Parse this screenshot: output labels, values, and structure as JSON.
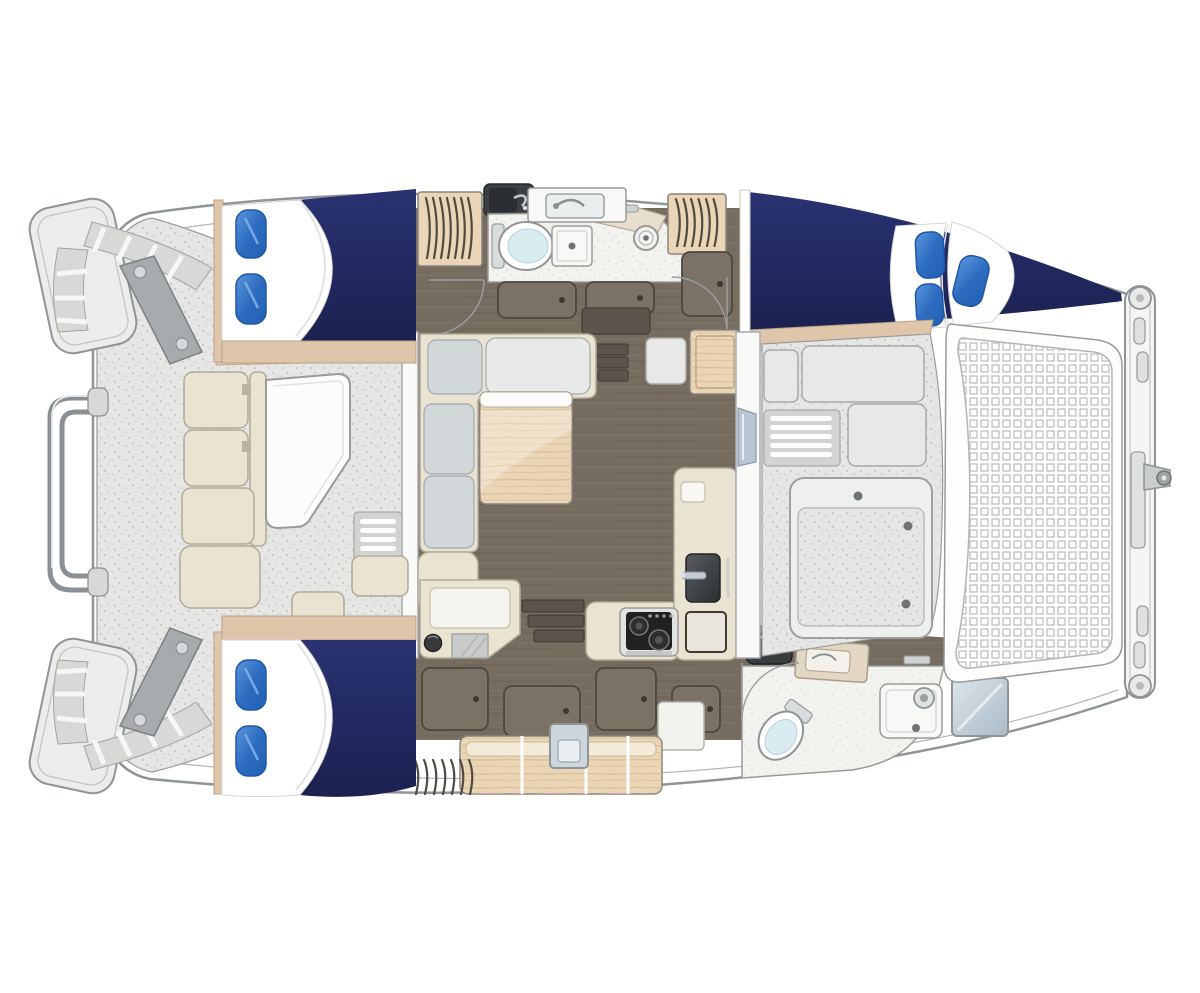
{
  "title": "Catamaran interior layout floor plan (top view)",
  "palette": {
    "hull-stroke": "#8f9496",
    "line-light": "#b3b7b9",
    "deck": "#e6e6e4",
    "deck-dot": "#c7c7c5",
    "deck-stroke": "#9a9a98",
    "navy": "#222a5e",
    "navy-dark": "#1a2150",
    "pillow": "#2e6cc0",
    "pillow-dark": "#1f57a8",
    "tan": "#dfc6ab",
    "salmon": "#e9c6ac",
    "wood": "#ead5b6",
    "wood-grain": "#d8b88e",
    "slat": "#4f4a42",
    "floor": "#766b5f",
    "streak-light": "#8a8072",
    "streak-dark": "#5f574d",
    "cream": "#e9e4d1",
    "cream-stroke": "#b0aa99",
    "gray-cushion": "#d2d7d9",
    "block": "#e8e8e6",
    "block-stroke": "#a9a9a7",
    "mesh-line": "#b5b6b4",
    "dark-appliance": "#3c4042",
    "steel": "#8b9094",
    "toilet-blue": "#d8ecf2",
    "window-blue": "#b7c6d2",
    "arc-line": "#9aa0a2",
    "locker": "#7b7165",
    "locker-stroke": "#4c463e",
    "step-dark": "#5c544b"
  },
  "regions": {
    "aft_deck": "cockpit deck with L-shaped bench and table",
    "stern_platforms": "two transom swim platforms with steps",
    "swim_ladder": "rail ladder on port transom",
    "aft_cabin_port": "double berth, navy spread, 2 blue pillows",
    "aft_cabin_starboard": "double berth, navy spread, 2 blue pillows",
    "forward_cabin": "tapered double berth, navy spread, 3 blue pillows",
    "head_port": "toilet, shower stall, vanity sink, round basin",
    "head_forward_starboard": "toilet, shower stall, vanity sink",
    "saloon": "L-shaped settee with wood table on plank floor",
    "nav_station": "chart desk with stool wedge",
    "galley": "cooktop with two burners, twin sinks, counters",
    "foredeck": "lockers, louver vent and large deck hatch",
    "trampoline": "mesh trampoline net at bow",
    "bow_crossbeam": "forward crossbeam with cleats and anchor roller"
  },
  "counts": {
    "blue_pillows": 7,
    "berths": 3,
    "heads": 2,
    "door_swings": 3
  }
}
